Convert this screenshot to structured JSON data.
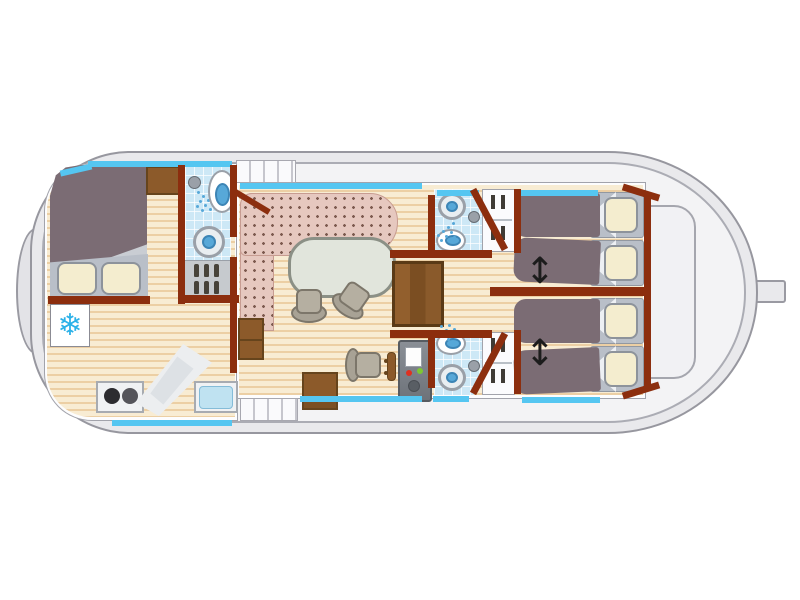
{
  "title": "Houseboat deck plan — top-down floor-plan illustration",
  "diagram": {
    "type": "floor-plan",
    "orientation": {
      "bow": "left",
      "stern": "right"
    }
  },
  "glyphs": {
    "fridge_snowflake": "❄",
    "bed_slide_arrow": "↕"
  },
  "colors": {
    "hull": "#e9e9ec",
    "hull_line": "#97979f",
    "deck": "#f3f3f5",
    "cabin": "#fdfdfe",
    "wall": "#8c2e0e",
    "floor": "#f8ecd3",
    "floor_stripe": "#eccfa4",
    "window_blue": "#55c6f1",
    "tile_blue": "#cde8f6",
    "fixture_blue": "#57a8d8",
    "sofa_pink": "#e6c8bf",
    "sofa_dot": "#7d5a4f",
    "table_green": "#e1e5dc",
    "chair_gray": "#b0aa9c",
    "blanket_mauve": "#7b6c74",
    "bed_frame_gray": "#b9bfc8",
    "pillow_cream": "#f4edcf",
    "wood_brown": "#8c5a2a",
    "wood_dark": "#66441c",
    "console_gray": "#7b8087",
    "button_red": "#e03020",
    "button_green": "#7dc832",
    "snowflake_blue": "#2bb1e8",
    "arrow_black": "#1c1c1c"
  },
  "areas": [
    {
      "name": "bow-cabin",
      "features": [
        "double-berth",
        "two-pillows",
        "fridge-freezer",
        "wardrobe"
      ]
    },
    {
      "name": "bow-bathroom",
      "features": [
        "shower",
        "toilet",
        "washbasin",
        "storage-shelf-with-bottles"
      ]
    },
    {
      "name": "galley",
      "features": [
        "two-burner-stove",
        "angled-worktop",
        "sink"
      ]
    },
    {
      "name": "saloon",
      "features": [
        "l-shaped-sofa",
        "dining-table",
        "two-swivel-chairs",
        "side-table",
        "cabinet"
      ]
    },
    {
      "name": "helm-station",
      "features": [
        "helm-seat",
        "steering-wheel",
        "instrument-console-with-red-and-green-buttons"
      ]
    },
    {
      "name": "aft-stairs",
      "features": [
        "three-plank-wooden-steps"
      ]
    },
    {
      "name": "aft-bathroom-top",
      "features": [
        "washbasin",
        "toilet",
        "shower"
      ]
    },
    {
      "name": "aft-bathroom-bottom",
      "features": [
        "washbasin",
        "toilet",
        "shower"
      ]
    },
    {
      "name": "aft-cabin-top",
      "features": [
        "two-single-berths",
        "slide-together-arrow",
        "wardrobe"
      ]
    },
    {
      "name": "aft-cabin-bottom",
      "features": [
        "two-single-berths",
        "slide-together-arrow",
        "wardrobe"
      ]
    },
    {
      "name": "side-decks",
      "features": [
        "forward-steps",
        "aft-steps",
        "window-strips"
      ]
    },
    {
      "name": "stern-deck",
      "features": [
        "locker-outline",
        "rudder"
      ]
    }
  ],
  "counts": {
    "single_berths_aft": 4,
    "double_berths_bow": 1,
    "bathrooms": 3,
    "window_strips": 9
  }
}
